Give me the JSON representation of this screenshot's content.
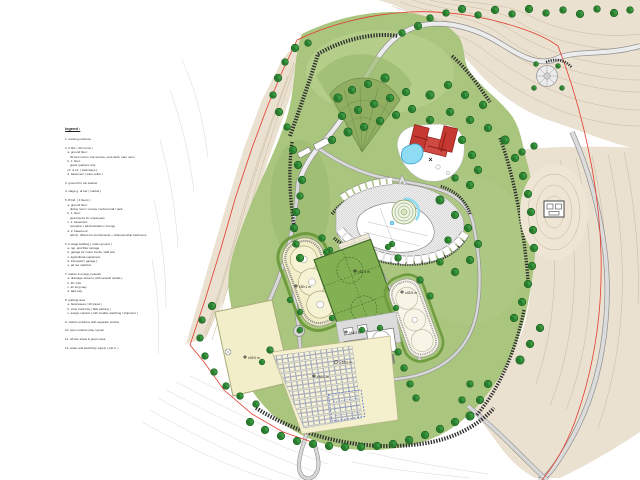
{
  "legend": {
    "title": "legend :",
    "body": "\n1. existing entrance\n\n2. A bld. ( 40 rooms )\n   a. ground floor:\n      30 twin rooms, bar-terrace, pool deck, care room\n   b. 1. floor:\n      guest quarters only\n   c1. & c2. ( staircases )\n   d. basement ( wine cellar )\n\n3. ground for car washer\n\n4. stage g. at bar ( market )\n\n5. B bld. ( 4 floors )\n   a. ground floor:\n      dining room / course / lecture hall / park\n   b. 1. floor:\n      apartments for employees\n   c. 1. basement:\n      reception / administration / lounge\n   d. 2. basement:\n      admin. offices for tournaments + championship bedrooms\n\n6. A stage building ( under ground )\n   a. rep. and filter storage\n   b. garage for motor trucks, staff pub\n   c. agricultural equipment\n   d. transyard ( garage )\n   e. ad net machine\n\n7. nature & energy network\n   a. drainage stream ( with several canals )\n   b. lift / pits\n   c. air long way\n   d. lake bay\n\n8. parking area\n   a. businesses ( 20 travel )\n   b. crew truck bay ( falls parking )\n   c. assign mastrol ( with smaller watching / shipment )\n\n9. visitors entrance with separate service\n\n10. open outdoor play / green\n\n11. off-site street & green area\n\n12. water and electricity supply ( site b. )"
  },
  "plan": {
    "markers": [
      {
        "label": "±50.1 m"
      },
      {
        "label": "±57.0 m"
      },
      {
        "label": "±48.5 m"
      },
      {
        "label": "±49.0 m"
      },
      {
        "label": "±52.0 m"
      },
      {
        "label": "±55.0 m"
      },
      {
        "label": "±58.2 m"
      }
    ]
  },
  "colors": {
    "boundary_red": "#e23b2e",
    "lawn_green": "#a9c57e",
    "tree_green": "#2f8a35",
    "hedge_green": "#1e5c22",
    "court_green": "#82b052",
    "field_cream": "#f2eec9",
    "terrain_beige": "#eae1d0",
    "roof_red": "#c63832",
    "pool_blue": "#8edcf4",
    "road_gray": "#d8d8d8",
    "overlay_blue": "#5a6fd0"
  }
}
